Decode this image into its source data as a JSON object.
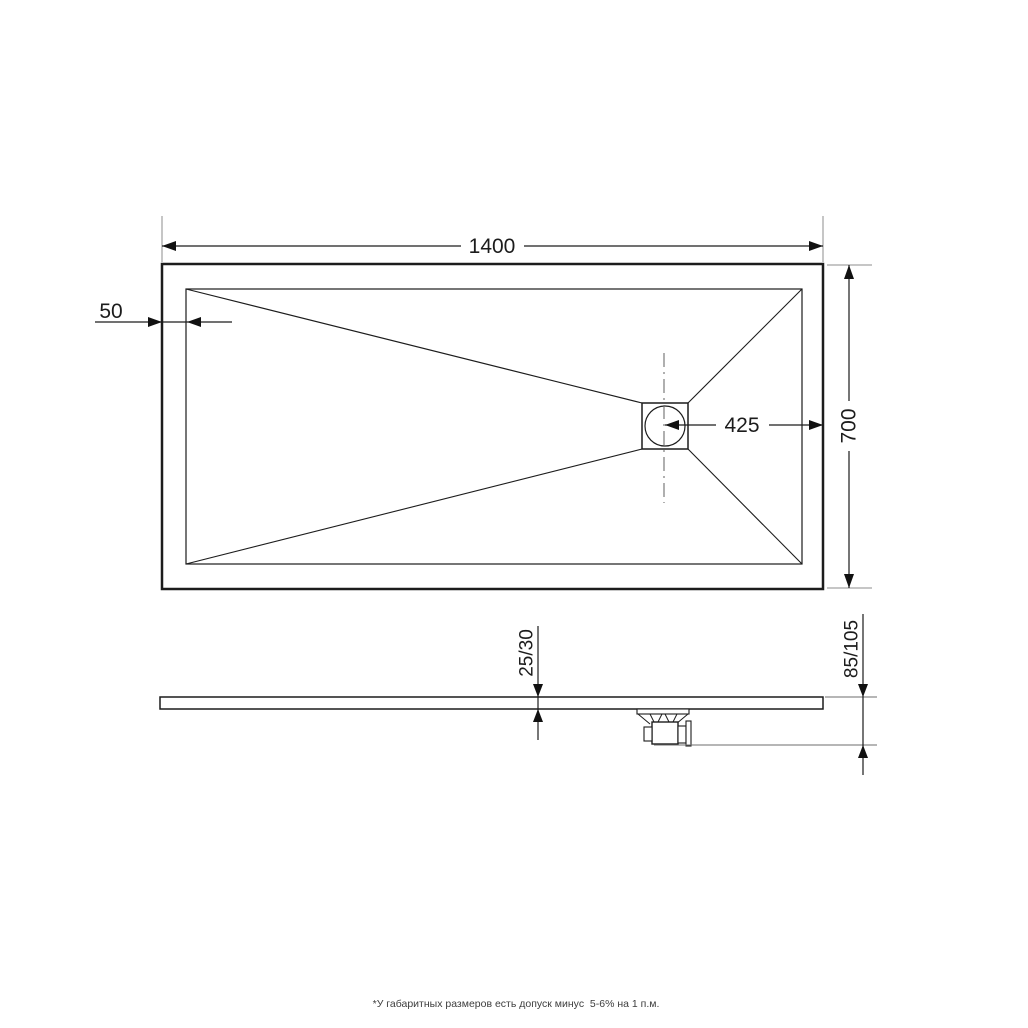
{
  "drawing": {
    "type": "technical-drawing-shower-tray",
    "top_view": {
      "length_label": "1400",
      "width_label": "700",
      "drain_offset_label": "425",
      "rim_width_label": "50"
    },
    "side_view": {
      "thickness_label": "25/30",
      "overall_height_label": "85/105"
    },
    "footnote": "*У габаритных размеров есть допуск минус  5-6% на 1 п.м.",
    "colors": {
      "line": "#1c1c1c",
      "extension_line": "#8c8c8c",
      "background": "#ffffff"
    }
  }
}
